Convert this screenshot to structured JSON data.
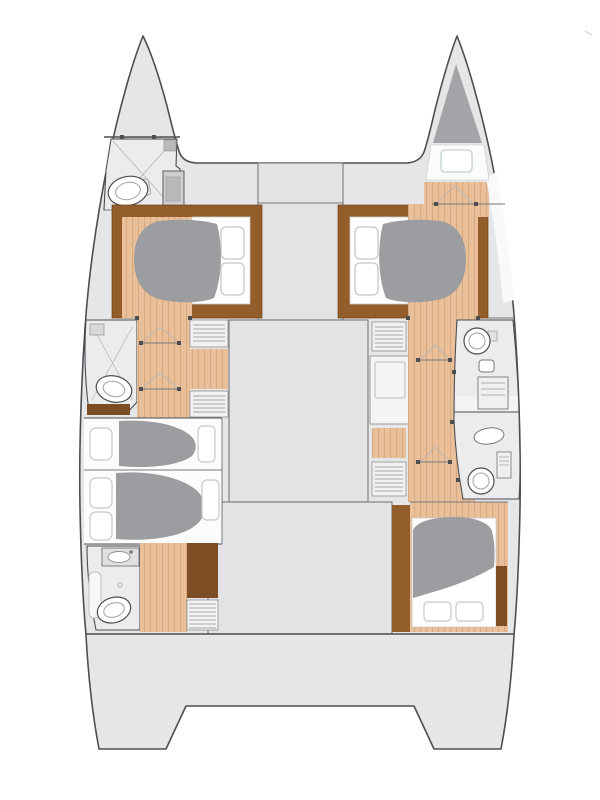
{
  "diagram": {
    "kind": "floorplan",
    "subject": "catamaran-yacht-lower-deck",
    "cabins_visible": 5,
    "bathrooms_visible": 5,
    "hulls": 2
  },
  "colors": {
    "background": "#ffffff",
    "deck": "#e5e6e7",
    "panel": "#e2e3e5",
    "fixture": "#ebeced",
    "outline": "#4d4e52",
    "line": "#77787b",
    "thinline": "#b4b5b8",
    "wood": "#e9c09a",
    "woodStripe": "#d6a77c",
    "brown": "#935d2c",
    "brownDark": "#7d4d24",
    "duvet": "#9c9da0",
    "locker": "#a3a4a7",
    "white": "#ffffff",
    "pillow": "#c6c7c9",
    "gunwale": "#f8f9f9",
    "unit": "#cdced0",
    "unitDark": "#b7b8ba"
  }
}
